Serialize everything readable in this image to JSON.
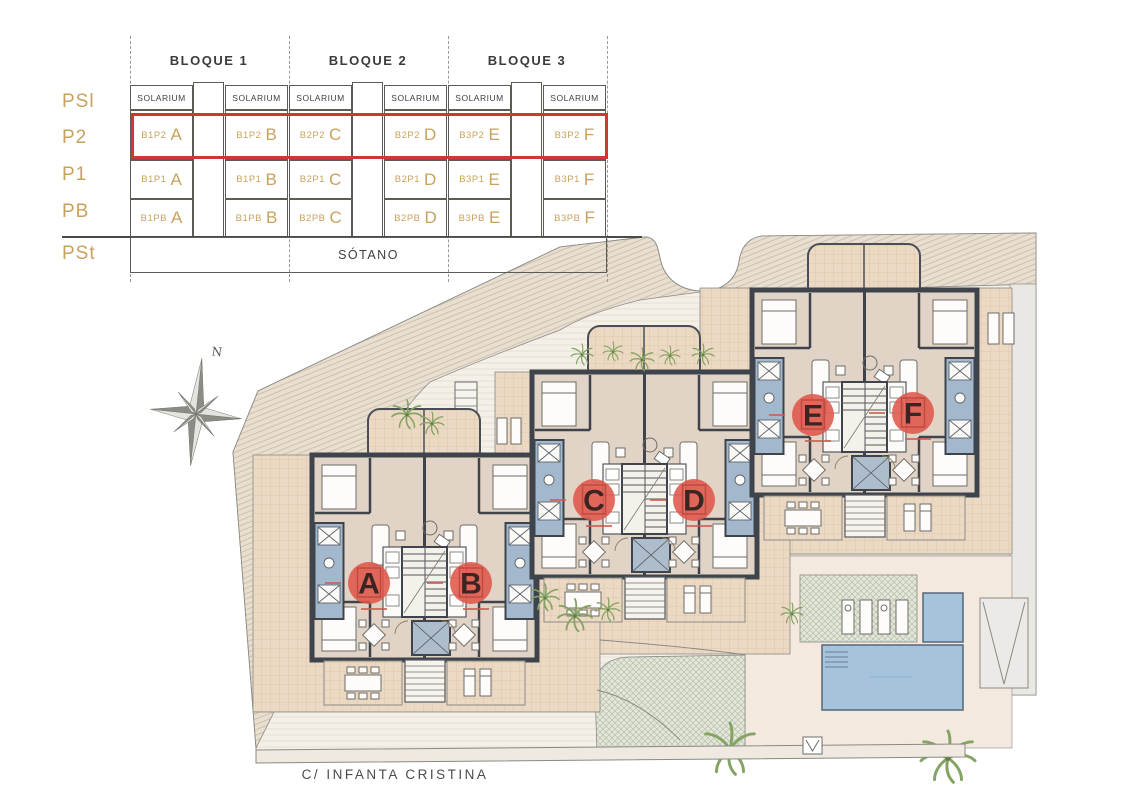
{
  "legend": {
    "floor_labels": [
      "PSl",
      "P2",
      "P1",
      "PB",
      "PSt"
    ],
    "block_headers": [
      "BLOQUE 1",
      "BLOQUE 2",
      "BLOQUE 3"
    ],
    "solarium_label": "SOLARIUM",
    "sotano_label": "SÓTANO",
    "unit_rows": [
      {
        "floor": "P2",
        "highlighted": true,
        "cells": [
          {
            "code": "B1P2",
            "letter": "A"
          },
          {
            "code": "B1P2",
            "letter": "B"
          },
          {
            "code": "B2P2",
            "letter": "C"
          },
          {
            "code": "B2P2",
            "letter": "D"
          },
          {
            "code": "B3P2",
            "letter": "E"
          },
          {
            "code": "B3P2",
            "letter": "F"
          }
        ]
      },
      {
        "floor": "P1",
        "highlighted": false,
        "cells": [
          {
            "code": "B1P1",
            "letter": "A"
          },
          {
            "code": "B1P1",
            "letter": "B"
          },
          {
            "code": "B2P1",
            "letter": "C"
          },
          {
            "code": "B2P1",
            "letter": "D"
          },
          {
            "code": "B3P1",
            "letter": "E"
          },
          {
            "code": "B3P1",
            "letter": "F"
          }
        ]
      },
      {
        "floor": "PB",
        "highlighted": false,
        "cells": [
          {
            "code": "B1PB",
            "letter": "A"
          },
          {
            "code": "B1PB",
            "letter": "B"
          },
          {
            "code": "B2PB",
            "letter": "C"
          },
          {
            "code": "B2PB",
            "letter": "D"
          },
          {
            "code": "B3PB",
            "letter": "E"
          },
          {
            "code": "B3PB",
            "letter": "F"
          }
        ]
      }
    ],
    "colors": {
      "gold": "#c8a25d",
      "highlight": "#cf382f",
      "header_text": "#3b3b3b"
    }
  },
  "site": {
    "street_label": "C/ INFANTA CRISTINA",
    "north_label": "N",
    "marker_color": "#e0554a",
    "units": [
      {
        "letter": "A",
        "x": 369,
        "y": 583
      },
      {
        "letter": "B",
        "x": 471,
        "y": 583
      },
      {
        "letter": "C",
        "x": 594,
        "y": 500
      },
      {
        "letter": "D",
        "x": 694,
        "y": 500
      },
      {
        "letter": "E",
        "x": 813,
        "y": 415
      },
      {
        "letter": "F",
        "x": 913,
        "y": 413
      }
    ]
  }
}
